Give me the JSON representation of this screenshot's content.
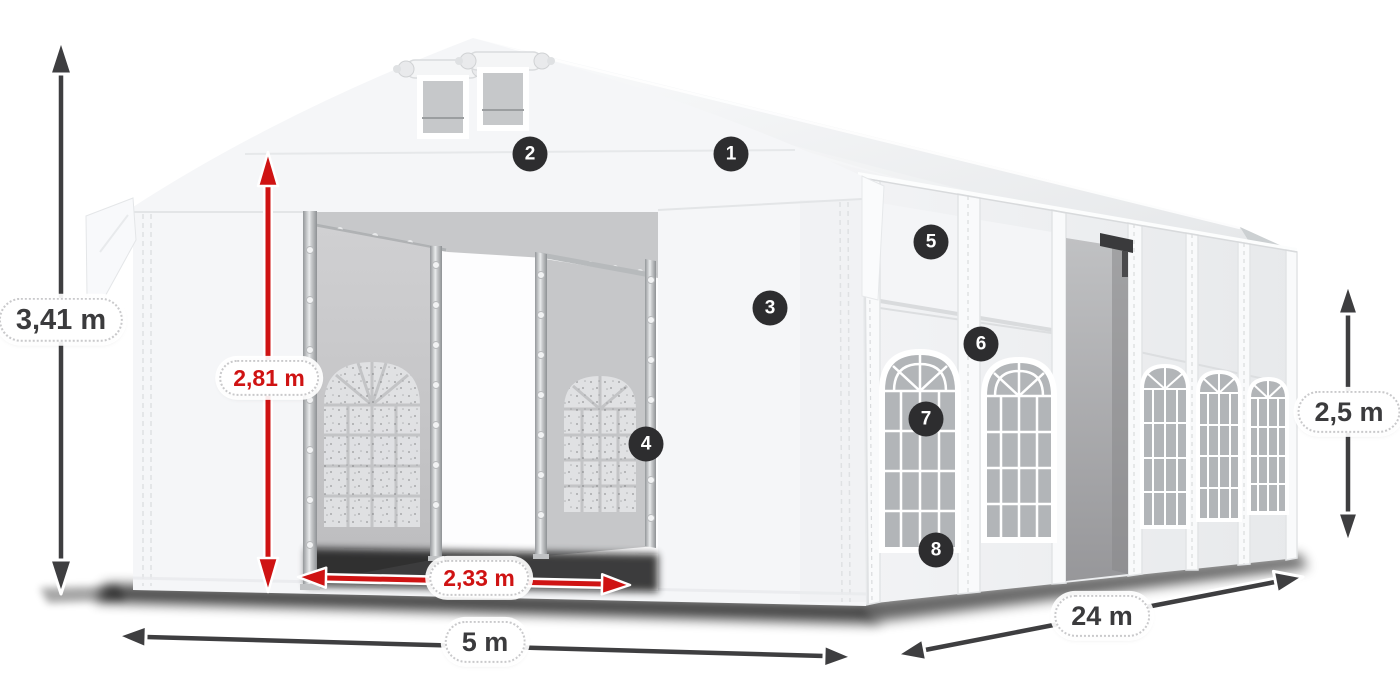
{
  "measurements": {
    "total_height": {
      "value": "3,41 m"
    },
    "entrance_height": {
      "value": "2,81 m"
    },
    "entrance_width": {
      "value": "2,33 m"
    },
    "front_width": {
      "value": "5 m"
    },
    "side_length": {
      "value": "24 m"
    },
    "wall_height": {
      "value": "2,5 m"
    }
  },
  "callouts": [
    {
      "number": "1"
    },
    {
      "number": "2"
    },
    {
      "number": "3"
    },
    {
      "number": "4"
    },
    {
      "number": "5"
    },
    {
      "number": "6"
    },
    {
      "number": "7"
    },
    {
      "number": "8"
    }
  ],
  "colors": {
    "dimension_primary": "#3e3e40",
    "dimension_accent": "#cf1313",
    "badge_background": "#2d2d2f",
    "badge_text": "#ffffff",
    "tent_fabric": "#f5f6f8",
    "glass": "#b2b5b8"
  }
}
